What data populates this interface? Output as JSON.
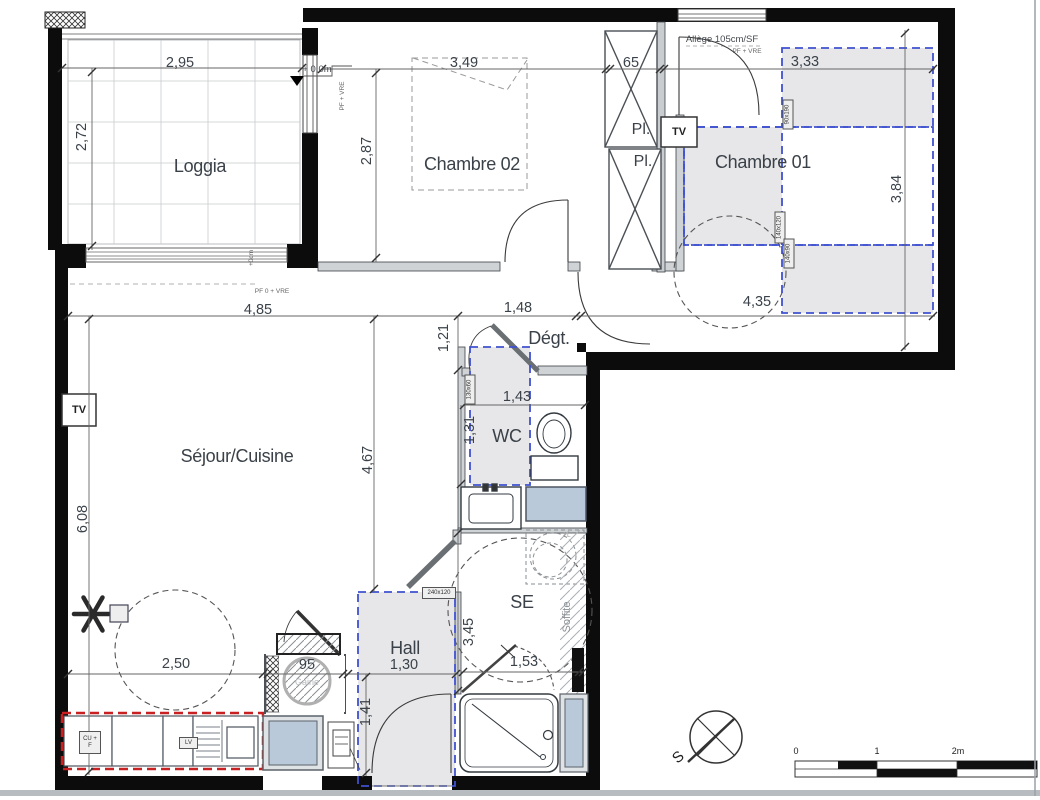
{
  "rooms": {
    "loggia": "Loggia",
    "chambre02": "Chambre 02",
    "chambre01": "Chambre 01",
    "sejour_cuisine": "Séjour/Cuisine",
    "degagement": "Dégt.",
    "wc": "WC",
    "salle_eau": "SE",
    "hall": "Hall",
    "placard_1": "Pl.",
    "placard_2": "Pl."
  },
  "dimensions": {
    "loggia_w": "2,95",
    "loggia_h": "2,72",
    "ch02_w": "3,49",
    "closet_w": "65",
    "ch01_w": "3,33",
    "ch02_h": "2,87",
    "ch01_h": "3,84",
    "sejour_w": "4,85",
    "degt_w": "1,48",
    "ch01_d": "4,35",
    "degt_h": "1,21",
    "wc_w": "1,43",
    "wc_h": "1,31",
    "sejour_h_right": "4,67",
    "sejour_h_left": "6,08",
    "se_h": "3,45",
    "se_w": "1,53",
    "table_diameter": "2,50",
    "gaine_w": "95",
    "hall_w": "1,30",
    "hall_h": "1,41"
  },
  "annotations": {
    "allege": "Allège 105cm/SF",
    "pf_vre": "PF + VRE",
    "pf0_vre": "PF 0 + VRE",
    "level": "+ 0,0m",
    "threshold": "+0cm",
    "soffite": "Soffite",
    "gaine": "Gaine",
    "tv": "TV",
    "washer": "LL"
  },
  "size_tags": {
    "bed_single": "90x190",
    "bed_double": "140x120",
    "zone_140": "140x90",
    "washbasin": "130x60",
    "hall_tag": "240x120"
  },
  "kitchen": {
    "unit_cu_f": "CU + F",
    "unit_lv": "LV"
  },
  "compass": {
    "south": "S"
  },
  "scalebar": {
    "zero": "0",
    "one": "1",
    "two": "2m"
  },
  "colors": {
    "wall": "#0c0c0c",
    "blue_dash": "#3f51cf",
    "red_dash": "#c92121",
    "glazing": "#b9c9da",
    "zone_fill": "#e7e7e9"
  }
}
